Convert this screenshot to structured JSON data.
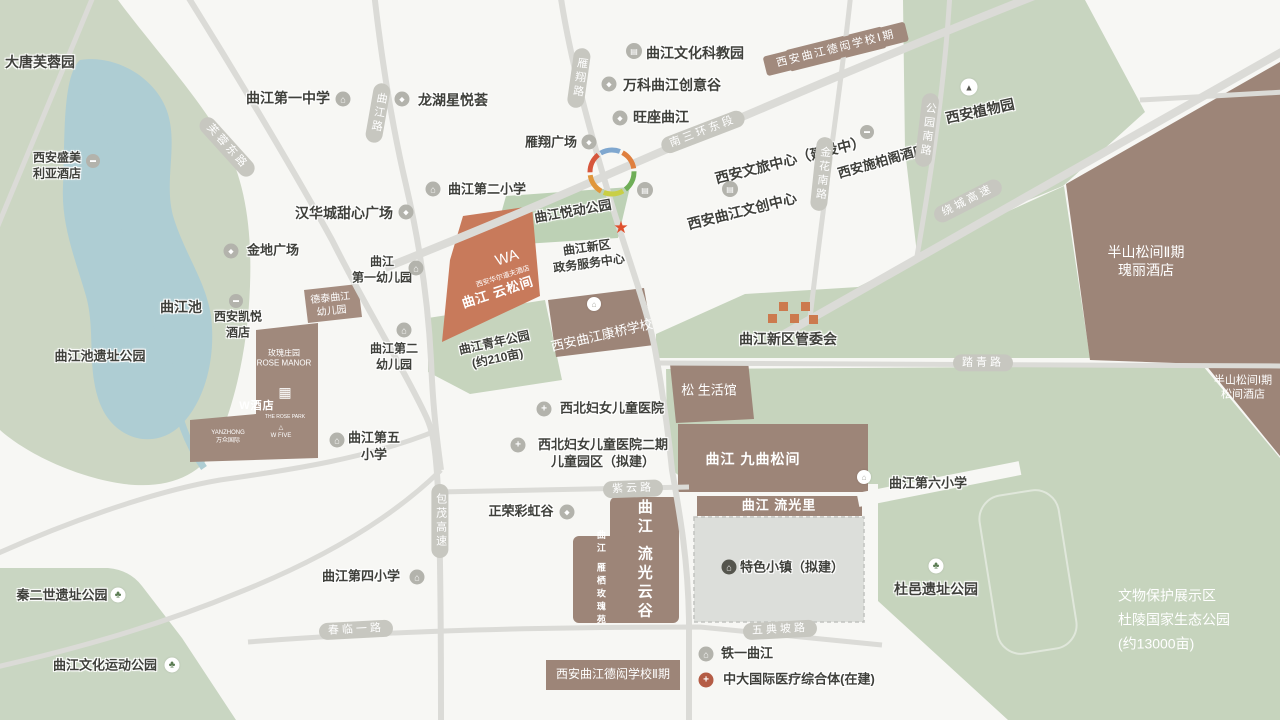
{
  "map_title": "曲江新区区位图",
  "colors": {
    "background": "#f7f7f4",
    "park_green": "#c6d4bd",
    "water_blue": "#aecdd3",
    "block_brown": "#9d8578",
    "highlight_salmon": "#c87a5b",
    "road_gray": "#dbdbd7",
    "road_pill": "#c7c7c0",
    "dark_text": "#3f403b",
    "star_red": "#e0512e",
    "logo_orange": "#cc7a4e",
    "cross_red": "#b45c45"
  },
  "road_labels": [
    {
      "name": "furong-east-road-label",
      "text": "芙蓉东路",
      "x": 227,
      "y": 147,
      "rot": 48,
      "v": false
    },
    {
      "name": "qujiang-road-label",
      "text": "曲江路",
      "x": 378,
      "y": 113,
      "rot": 10,
      "v": true
    },
    {
      "name": "yanxiang-road-label",
      "text": "雁翔路",
      "x": 579,
      "y": 78,
      "rot": 8,
      "v": true
    },
    {
      "name": "south-3rd-ring-east-label",
      "text": "南三环东段",
      "x": 703,
      "y": 132,
      "rot": -21,
      "v": false
    },
    {
      "name": "jinhua-south-road-label",
      "text": "金花南路",
      "x": 822,
      "y": 174,
      "rot": 6,
      "v": true
    },
    {
      "name": "gongyuan-south-road-label",
      "text": "公园南路",
      "x": 927,
      "y": 130,
      "rot": 7,
      "v": true
    },
    {
      "name": "raocheng-expressway-label",
      "text": "绕城高速",
      "x": 968,
      "y": 201,
      "rot": -27,
      "v": false
    },
    {
      "name": "taqing-road-label",
      "text": "踏青路",
      "x": 983,
      "y": 363,
      "rot": 0,
      "v": false
    },
    {
      "name": "ziyun-road-label",
      "text": "紫云路",
      "x": 633,
      "y": 489,
      "rot": -2,
      "v": false
    },
    {
      "name": "baomao-expressway-label",
      "text": "包茂高速",
      "x": 440,
      "y": 521,
      "rot": 0,
      "v": true
    },
    {
      "name": "chunlin-1st-road-label",
      "text": "春临一路",
      "x": 356,
      "y": 630,
      "rot": -3,
      "v": false
    },
    {
      "name": "wudianpo-road-label",
      "text": "五典坡路",
      "x": 780,
      "y": 630,
      "rot": -3,
      "v": false
    }
  ],
  "labels": [
    {
      "name": "tang-paradise-label",
      "lines": [
        "大唐芙蓉园"
      ],
      "x": 40,
      "y": 62,
      "fs": 14
    },
    {
      "name": "shengmeiliya-hotel-label",
      "lines": [
        "西安盛美",
        "利亚酒店"
      ],
      "x": 57,
      "y": 166,
      "fs": 12
    },
    {
      "name": "qujiang-pool-label",
      "lines": [
        "曲江池"
      ],
      "x": 181,
      "y": 307,
      "fs": 14
    },
    {
      "name": "qujiang-pool-ruins-park-label",
      "lines": [
        "曲江池遗址公园"
      ],
      "x": 100,
      "y": 357,
      "fs": 13
    },
    {
      "name": "hyatt-hotel-label",
      "lines": [
        "西安凯悦",
        "酒店"
      ],
      "x": 238,
      "y": 325,
      "fs": 12
    },
    {
      "name": "jindi-plaza-label",
      "lines": [
        "金地广场"
      ],
      "x": 273,
      "y": 251,
      "fs": 13
    },
    {
      "name": "qujiang-no1-middle-school-label",
      "lines": [
        "曲江第一中学"
      ],
      "x": 288,
      "y": 98,
      "fs": 14
    },
    {
      "name": "longhu-xingyuehui-label",
      "lines": [
        "龙湖星悦荟"
      ],
      "x": 453,
      "y": 100,
      "fs": 14
    },
    {
      "name": "hanhuacheng-plaza-label",
      "lines": [
        "汉华城甜心广场"
      ],
      "x": 344,
      "y": 213,
      "fs": 14
    },
    {
      "name": "no1-kindergarten-label",
      "lines": [
        "曲江",
        "第一幼儿园"
      ],
      "x": 382,
      "y": 270,
      "fs": 12
    },
    {
      "name": "no2-kindergarten-label",
      "lines": [
        "曲江第二",
        "幼儿园"
      ],
      "x": 394,
      "y": 357,
      "fs": 12
    },
    {
      "name": "no5-primary-school-label",
      "lines": [
        "曲江第五",
        "小学"
      ],
      "x": 374,
      "y": 447,
      "fs": 13
    },
    {
      "name": "no2-primary-school-label",
      "lines": [
        "曲江第二小学"
      ],
      "x": 487,
      "y": 190,
      "fs": 13
    },
    {
      "name": "culture-science-park-label",
      "lines": [
        "曲江文化科教园"
      ],
      "x": 695,
      "y": 53,
      "fs": 14
    },
    {
      "name": "vanke-creative-valley-label",
      "lines": [
        "万科曲江创意谷"
      ],
      "x": 672,
      "y": 85,
      "fs": 14
    },
    {
      "name": "wangzuo-qujiang-label",
      "lines": [
        "旺座曲江"
      ],
      "x": 661,
      "y": 117,
      "fs": 14
    },
    {
      "name": "yanxiang-plaza-label",
      "lines": [
        "雁翔广场"
      ],
      "x": 551,
      "y": 143,
      "fs": 13
    },
    {
      "name": "wenlv-center-label",
      "lines": [
        "西安文旅中心（建设中）"
      ],
      "x": 790,
      "y": 160,
      "rot": -14,
      "fs": 14
    },
    {
      "name": "wenchuang-center-label",
      "lines": [
        "西安曲江文创中心"
      ],
      "x": 742,
      "y": 211,
      "rot": -14,
      "fs": 14
    },
    {
      "name": "steigenberger-hotel-label",
      "lines": [
        "西安施柏阁酒店"
      ],
      "x": 882,
      "y": 162,
      "rot": -16,
      "fs": 13
    },
    {
      "name": "botanical-garden-label",
      "lines": [
        "西安植物园"
      ],
      "x": 980,
      "y": 111,
      "rot": -12,
      "fs": 14
    },
    {
      "name": "dehong-school-phase1-label",
      "lines": [
        "西安曲江德闳学校Ⅰ期"
      ],
      "x": 836,
      "y": 49,
      "rot": -14,
      "cls": "bp",
      "fs": 11
    },
    {
      "name": "banshan-phase2-label",
      "lines": [
        "半山松间Ⅱ期",
        "瑰丽酒店"
      ],
      "x": 1146,
      "y": 261,
      "cls": "w",
      "fs": 14
    },
    {
      "name": "banshan-phase1-label",
      "lines": [
        "半山松间Ⅰ期",
        "松间酒店"
      ],
      "x": 1243,
      "y": 388,
      "cls": "w",
      "fs": 11
    },
    {
      "name": "management-committee-label",
      "lines": [
        "曲江新区管委会"
      ],
      "x": 788,
      "y": 339,
      "fs": 14
    },
    {
      "name": "government-service-center-label",
      "lines": [
        "曲江新区",
        "政务服务中心"
      ],
      "x": 588,
      "y": 256,
      "rot": -8,
      "fs": 12
    },
    {
      "name": "yuedong-park-label",
      "lines": [
        "曲江悦动公园"
      ],
      "x": 573,
      "y": 212,
      "rot": -10,
      "fs": 13
    },
    {
      "name": "youth-park-label",
      "lines": [
        "曲江青年公园",
        "(约210亩)"
      ],
      "x": 496,
      "y": 351,
      "rot": -12,
      "fs": 12
    },
    {
      "name": "kangqiao-school-label",
      "lines": [
        "西安曲江康桥学校"
      ],
      "x": 602,
      "y": 336,
      "rot": -13,
      "cls": "w",
      "fs": 13
    },
    {
      "name": "waldorf-hotel-label",
      "lines": [
        "西安华尔道夫酒店"
      ],
      "x": 503,
      "y": 277,
      "rot": -18,
      "cls": "w",
      "fs": 7
    },
    {
      "name": "yunsongjian-label",
      "lines": [
        "曲江 云松间"
      ],
      "x": 498,
      "y": 293,
      "rot": -18,
      "cls": "wb",
      "fs": 13
    },
    {
      "name": "waldorf-monogram",
      "lines": [
        "WA"
      ],
      "x": 507,
      "y": 258,
      "rot": -18,
      "cls": "w",
      "fs": 15
    },
    {
      "name": "song-life-hall-label",
      "lines": [
        "松 生活馆"
      ],
      "x": 709,
      "y": 391,
      "cls": "w",
      "fs": 13
    },
    {
      "name": "jiuqu-songjian-label",
      "lines": [
        "曲江 九曲松间"
      ],
      "x": 753,
      "y": 459,
      "cls": "wb",
      "fs": 14
    },
    {
      "name": "liuguangli-label",
      "lines": [
        "曲江 流光里"
      ],
      "x": 779,
      "y": 506,
      "cls": "wb",
      "fs": 13
    },
    {
      "name": "tese-town-label",
      "lines": [
        "特色小镇（拟建）"
      ],
      "x": 792,
      "y": 568,
      "fs": 13
    },
    {
      "name": "liuguang-yungu-label",
      "lines": [
        "曲江 流光云谷"
      ],
      "x": 644,
      "y": 560,
      "cls": "wv",
      "fs": 15
    },
    {
      "name": "yanqi-rose-garden-label",
      "lines": [
        "曲江 雁栖玫瑰苑"
      ],
      "x": 600,
      "y": 579,
      "cls": "wv",
      "fs": 9
    },
    {
      "name": "dehong-school-phase2-label",
      "lines": [
        "西安曲江德闳学校Ⅱ期"
      ],
      "x": 613,
      "y": 675,
      "cls": "w",
      "fs": 12
    },
    {
      "name": "no6-primary-school-label",
      "lines": [
        "曲江第六小学"
      ],
      "x": 928,
      "y": 484,
      "fs": 13
    },
    {
      "name": "duyi-ruins-park-label",
      "lines": [
        "杜邑遗址公园"
      ],
      "x": 936,
      "y": 589,
      "fs": 14
    },
    {
      "name": "tieyi-qujiang-label",
      "lines": [
        "铁一曲江"
      ],
      "x": 747,
      "y": 654,
      "fs": 13
    },
    {
      "name": "zhongda-medical-label",
      "lines": [
        "中大国际医疗综合体(在建)"
      ],
      "x": 799,
      "y": 680,
      "fs": 13
    },
    {
      "name": "no4-primary-school-label",
      "lines": [
        "曲江第四小学"
      ],
      "x": 361,
      "y": 577,
      "fs": 13
    },
    {
      "name": "qinershi-ruins-park-label",
      "lines": [
        "秦二世遗址公园"
      ],
      "x": 62,
      "y": 596,
      "fs": 13
    },
    {
      "name": "culture-sports-park-label",
      "lines": [
        "曲江文化运动公园"
      ],
      "x": 105,
      "y": 666,
      "fs": 13
    },
    {
      "name": "zhengrong-rainbow-label",
      "lines": [
        "正荣彩虹谷"
      ],
      "x": 521,
      "y": 512,
      "fs": 13
    },
    {
      "name": "women-children-hospital-label",
      "lines": [
        "西北妇女儿童医院"
      ],
      "x": 612,
      "y": 409,
      "fs": 13
    },
    {
      "name": "women-children-hospital2-label",
      "lines": [
        "西北妇女儿童医院二期",
        "儿童园区（拟建）"
      ],
      "x": 603,
      "y": 454,
      "fs": 13
    },
    {
      "name": "duling-eco-park-label",
      "lines": [
        "文物保护展示区",
        "杜陵国家生态公园",
        "(约13000亩)"
      ],
      "x": 1118,
      "y": 620,
      "cls": "wl",
      "fs": 14,
      "a": "l"
    },
    {
      "name": "rose-manor-label",
      "lines": [
        "玫瑰庄园",
        "ROSE MANOR"
      ],
      "x": 284,
      "y": 359,
      "cls": "w",
      "fs": 8
    },
    {
      "name": "rose-park-qr-logo",
      "lines": [
        "▦"
      ],
      "x": 285,
      "y": 392,
      "cls": "w",
      "fs": 14
    },
    {
      "name": "rose-park-label",
      "lines": [
        "THE ROSE PARK"
      ],
      "x": 285,
      "y": 417,
      "cls": "w",
      "fs": 5
    },
    {
      "name": "w-hotel-label",
      "lines": [
        "W酒店"
      ],
      "x": 257,
      "y": 406,
      "cls": "wb",
      "fs": 11
    },
    {
      "name": "yanzhong-label",
      "lines": [
        "YANZHONG",
        "万众国际"
      ],
      "x": 228,
      "y": 438,
      "cls": "w",
      "fs": 6
    },
    {
      "name": "w-five-label",
      "lines": [
        "△",
        "W FIVE"
      ],
      "x": 281,
      "y": 433,
      "cls": "w",
      "fs": 6
    },
    {
      "name": "detai-kindergarten-label",
      "lines": [
        "德泰曲江",
        "幼儿园"
      ],
      "x": 331,
      "y": 305,
      "rot": -6,
      "cls": "w",
      "fs": 10
    }
  ],
  "icons": [
    {
      "name": "no1-middle-school-icon",
      "x": 343,
      "y": 99,
      "cls": "s",
      "g": "⌂"
    },
    {
      "name": "no2-primary-school-icon",
      "x": 433,
      "y": 189,
      "cls": "s",
      "g": "⌂"
    },
    {
      "name": "no1-kindergarten-icon",
      "x": 416,
      "y": 268,
      "cls": "s",
      "g": "⌂"
    },
    {
      "name": "no2-kindergarten-icon",
      "x": 404,
      "y": 330,
      "cls": "s",
      "g": "⌂"
    },
    {
      "name": "no5-primary-school-icon",
      "x": 337,
      "y": 440,
      "cls": "s",
      "g": "⌂"
    },
    {
      "name": "no4-primary-school-icon",
      "x": 417,
      "y": 577,
      "cls": "s",
      "g": "⌂"
    },
    {
      "name": "no6-primary-school-icon",
      "x": 864,
      "y": 477,
      "cls": "s2",
      "g": "⌂"
    },
    {
      "name": "tieyi-school-icon",
      "x": 706,
      "y": 654,
      "cls": "s",
      "g": "⌂"
    },
    {
      "name": "longhu-mall-icon",
      "x": 402,
      "y": 99,
      "cls": "m",
      "g": "◆"
    },
    {
      "name": "jindi-mall-icon",
      "x": 231,
      "y": 251,
      "cls": "m",
      "g": "◆"
    },
    {
      "name": "hanhuacheng-mall-icon",
      "x": 406,
      "y": 212,
      "cls": "m",
      "g": "◆"
    },
    {
      "name": "vanke-mall-icon",
      "x": 609,
      "y": 84,
      "cls": "m",
      "g": "◆"
    },
    {
      "name": "wangzuo-mall-icon",
      "x": 620,
      "y": 118,
      "cls": "m",
      "g": "◆"
    },
    {
      "name": "yanxiang-plaza-mall-icon",
      "x": 589,
      "y": 142,
      "cls": "m",
      "g": "◆"
    },
    {
      "name": "zhengrong-mall-icon",
      "x": 567,
      "y": 512,
      "cls": "m",
      "g": "◆"
    },
    {
      "name": "science-park-building-icon",
      "x": 634,
      "y": 51,
      "cls": "b",
      "g": "▤"
    },
    {
      "name": "wenlv-building-icon",
      "x": 645,
      "y": 190,
      "cls": "b",
      "g": "▤"
    },
    {
      "name": "wenchuang-building-icon",
      "x": 730,
      "y": 189,
      "cls": "b",
      "g": "▤"
    },
    {
      "name": "shengmeiliya-hotel-icon",
      "x": 93,
      "y": 161,
      "cls": "h",
      "g": "▬"
    },
    {
      "name": "hyatt-hotel-icon",
      "x": 236,
      "y": 301,
      "cls": "h",
      "g": "▬"
    },
    {
      "name": "steigenberger-hotel-icon",
      "x": 867,
      "y": 132,
      "cls": "h",
      "g": "▬"
    },
    {
      "name": "hospital-cross-icon",
      "x": 544,
      "y": 409,
      "cls": "x",
      "g": "+"
    },
    {
      "name": "hospital2-cross-icon",
      "x": 518,
      "y": 445,
      "cls": "x",
      "g": "+"
    },
    {
      "name": "qinershi-tree-icon",
      "x": 118,
      "y": 595,
      "cls": "t",
      "g": "♣"
    },
    {
      "name": "sports-park-tree-icon",
      "x": 172,
      "y": 665,
      "cls": "t",
      "g": "♣"
    },
    {
      "name": "duyi-tree-icon",
      "x": 936,
      "y": 566,
      "cls": "t",
      "g": "♣"
    },
    {
      "name": "botanical-tower-icon",
      "x": 969,
      "y": 87,
      "cls": "tw",
      "g": "▲"
    },
    {
      "name": "service-center-star-icon",
      "x": 621,
      "y": 228,
      "cls": "st",
      "g": "★"
    },
    {
      "name": "tese-town-icon",
      "x": 729,
      "y": 567,
      "cls": "dk",
      "g": "⌂"
    },
    {
      "name": "zhongda-medical-cross-icon",
      "x": 706,
      "y": 680,
      "cls": "rx",
      "g": "+"
    },
    {
      "name": "kangqiao-school-icon",
      "x": 594,
      "y": 304,
      "cls": "s2",
      "g": "⌂"
    }
  ]
}
